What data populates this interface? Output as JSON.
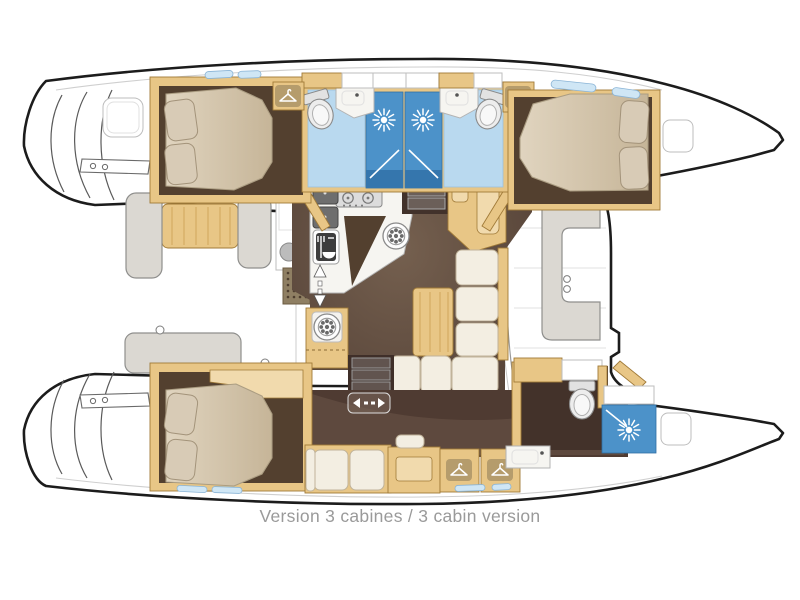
{
  "caption": {
    "text": "Version 3 cabines / 3 cabin version"
  },
  "colors": {
    "hull_outline": "#1c1c1c",
    "wood": "#e8c686",
    "wood_light": "#f1daad",
    "wood_border": "#a07a38",
    "floor_brown": "#53402f",
    "floor_brown_dark": "#43322a",
    "floor_brown_light": "#6d574a",
    "mattress": "#d9ccb5",
    "pillow": "#d8cbb6",
    "cushion_white": "#f3eee2",
    "bench_gray": "#dbd8d2",
    "bench_line": "#8f8f8d",
    "bath_floor": "#b9d9ef",
    "shower_blue": "#4c92c9",
    "shower_blue_dark": "#3576ad",
    "window_blue": "#cfe6f5",
    "caption_gray": "#9a9a9a"
  },
  "icons": {
    "shower_head": "sunburst",
    "wardrobe": "clothes-hanger",
    "toilet": "toilet-top-view",
    "stove": "four-burner-hob",
    "galley_sink": "double-sink",
    "fridge": "fridge-cutlery",
    "vent_fan": "round-vent",
    "entry_arrow": "up-down-arrow",
    "sliding_door": "left-right-arrow",
    "cup_holders": "two-circles"
  },
  "areas": {
    "port_hull": [
      "aft-double-cabin",
      "aft-shower-room",
      "forward-shower-room",
      "forward-double-cabin"
    ],
    "starboard_hull": [
      "owner-aft-berth",
      "owner-lounge-desk",
      "owner-wardrobes",
      "owner-bathroom"
    ],
    "nacelle": [
      "galley",
      "chart-table",
      "saloon-settee",
      "aft-cockpit",
      "forward-cockpit"
    ]
  }
}
